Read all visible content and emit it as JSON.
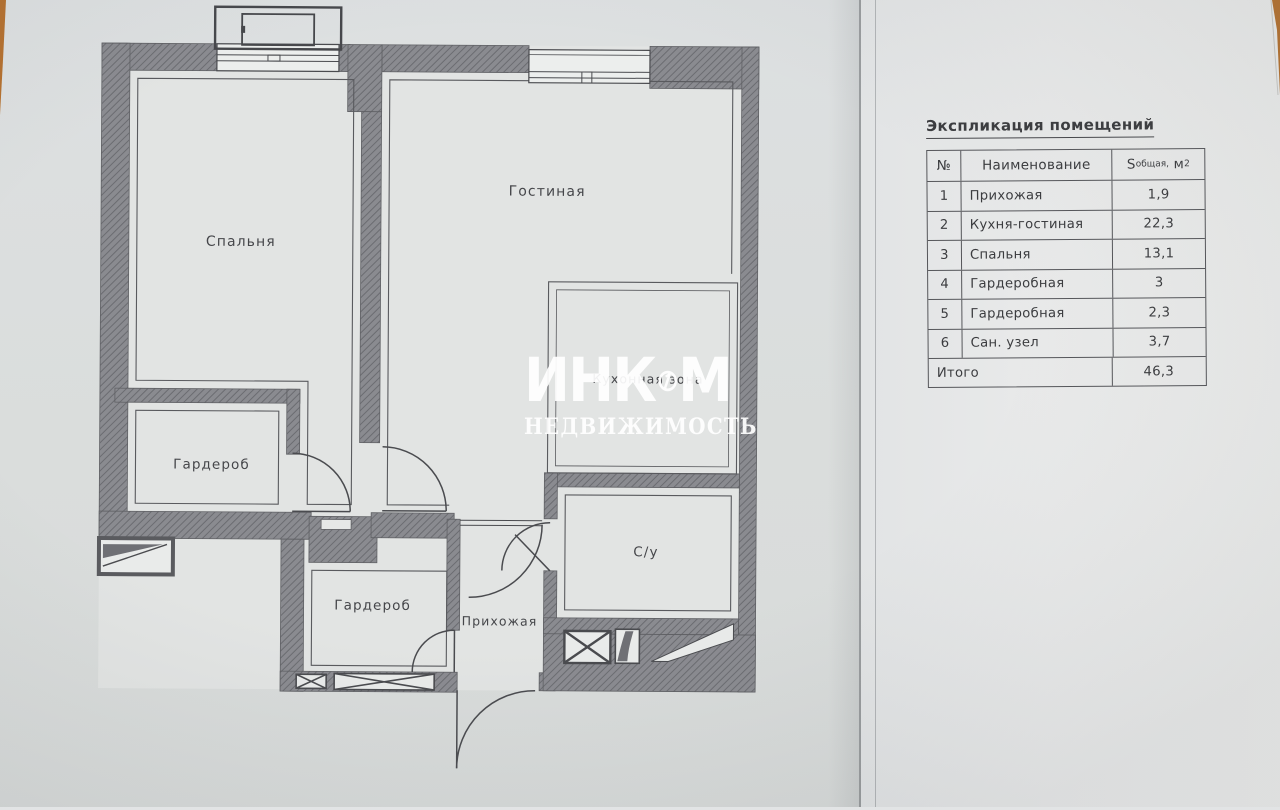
{
  "explication": {
    "title": "Экспликация помещений",
    "header": {
      "num": "№",
      "name": "Наименование",
      "area_s": "S",
      "area_sub": "общая,",
      "area_unit": " м",
      "area_sup": "2"
    },
    "rows": [
      {
        "num": "1",
        "name": "Прихожая",
        "area": "1,9"
      },
      {
        "num": "2",
        "name": "Кухня-гостиная",
        "area": "22,3"
      },
      {
        "num": "3",
        "name": "Спальня",
        "area": "13,1"
      },
      {
        "num": "4",
        "name": "Гардеробная",
        "area": "3"
      },
      {
        "num": "5",
        "name": "Гардеробная",
        "area": "2,3"
      },
      {
        "num": "6",
        "name": "Сан. узел",
        "area": "3,7"
      }
    ],
    "total": {
      "label": "Итого",
      "value": "46,3"
    }
  },
  "floor_plan": {
    "labels": {
      "bedroom": "Спальня",
      "living": "Гостиная",
      "kitchen_zone": "Кухонная зона",
      "wardrobe_1": "Гардероб",
      "wardrobe_2": "Гардероб",
      "hallway": "Прихожая",
      "bathroom": "С/у"
    }
  },
  "watermark": {
    "line1_left": "ИНК",
    "line1_right": "М",
    "line2": "НЕДВИЖИМОСТЬ"
  },
  "colors": {
    "wall": "#8a8b90",
    "wall_hatch": "#6b6c71",
    "line": "#4a4b4f",
    "paper_left": "#dcdfe0",
    "paper_right": "#e9eaea",
    "wood": "#b5712f",
    "text": "#3b3c3f"
  }
}
